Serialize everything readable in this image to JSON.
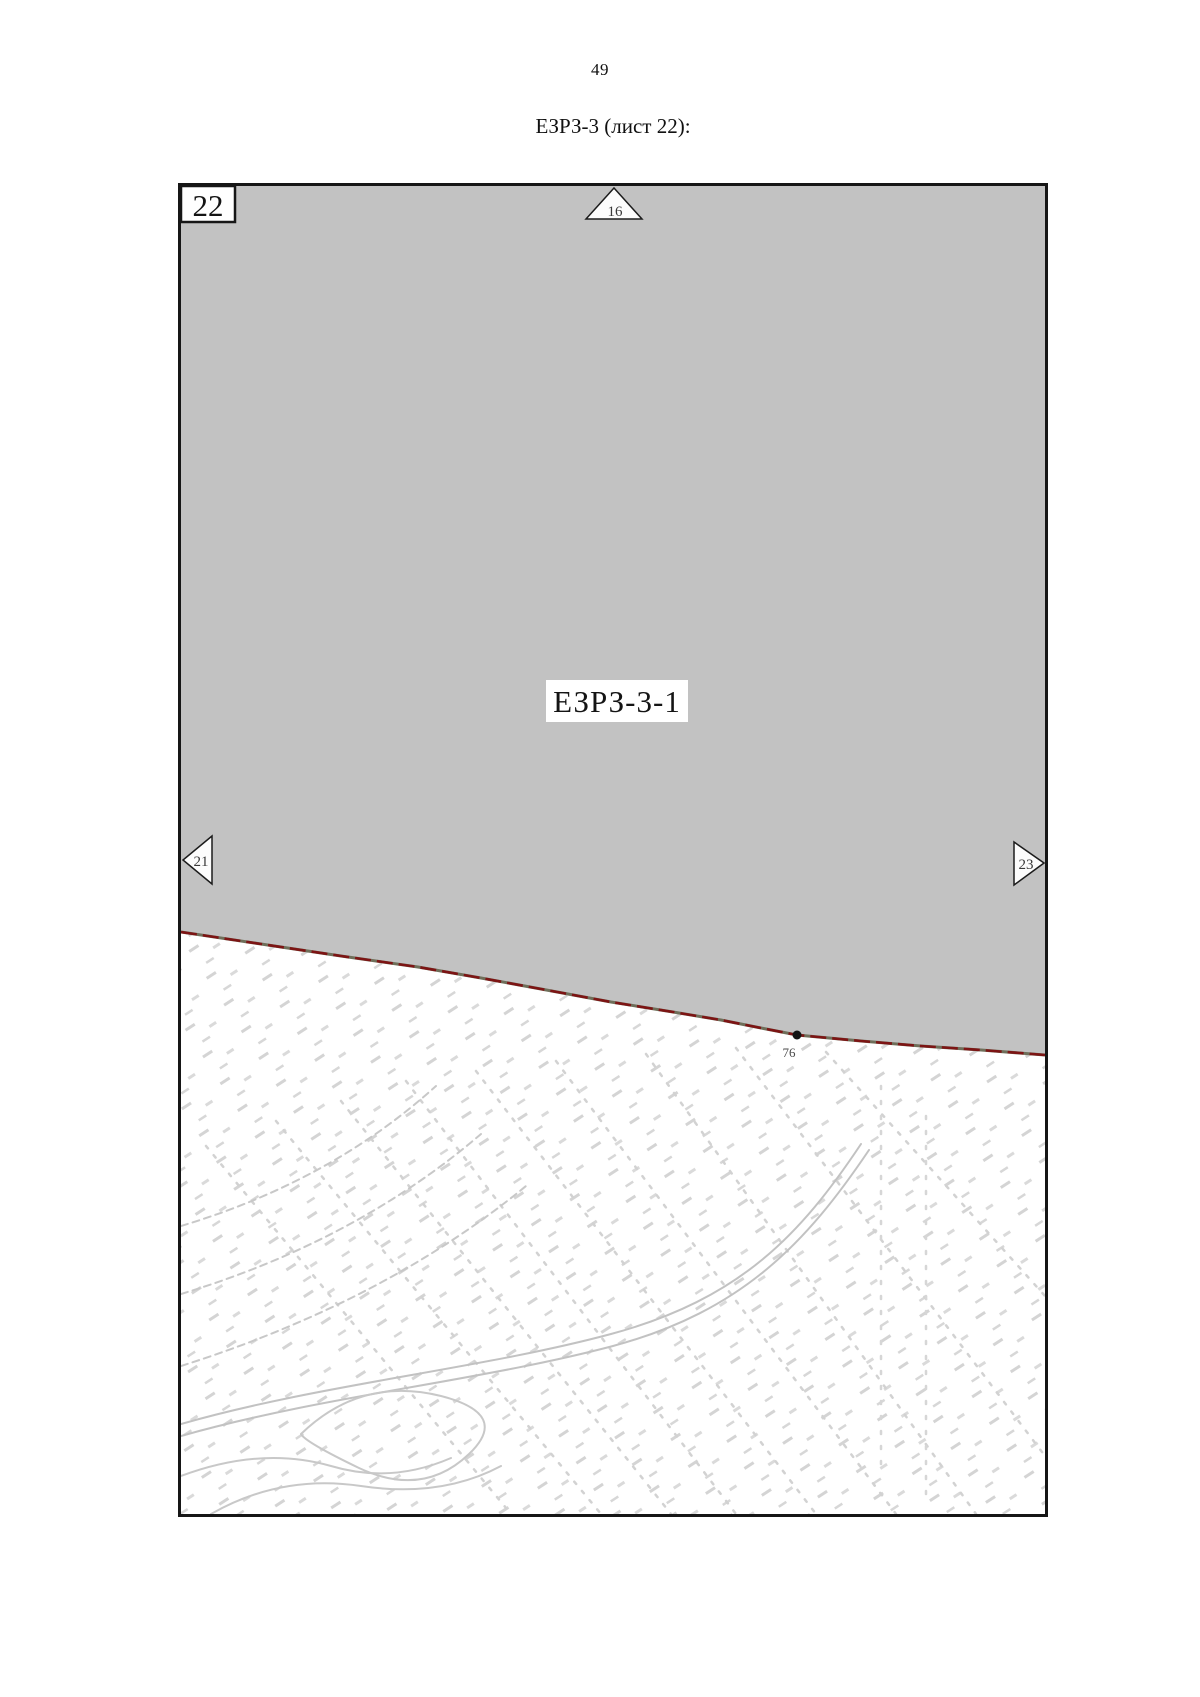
{
  "page": {
    "number": "49",
    "title": "ЕЗРЗ-3 (лист 22):"
  },
  "map": {
    "sheet_number": "22",
    "zone_label": "ЕЗРЗ-3-1",
    "boundary_point": "76",
    "adjacent_sheets": {
      "top": "16",
      "left": "21",
      "right": "23"
    },
    "colors": {
      "zone_fill": "#c2c2c2",
      "boundary_line": "#7d1414",
      "boundary_underlay": "#6f6f5a",
      "frame": "#161616",
      "label_text": "#141414",
      "texture": "#d2d2d2"
    }
  }
}
